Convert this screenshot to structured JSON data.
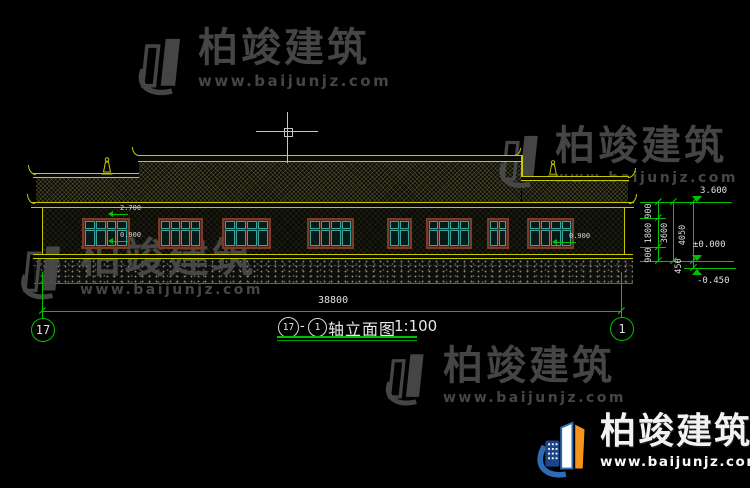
{
  "brand": {
    "name": "柏竣建筑",
    "url": "www.baijunjz.com"
  },
  "title_block": {
    "axis_from": "17",
    "separator": "-",
    "axis_to": "1",
    "title": "轴立面图",
    "scale": "1:100"
  },
  "axis_bubbles": {
    "left": "17",
    "right": "1"
  },
  "dimensions": {
    "overall_width": "38800",
    "right_chain_segments": [
      "900",
      "1800",
      "900"
    ],
    "story_height": "3600",
    "total_height": "4050",
    "plinth_height": "450"
  },
  "levels": {
    "eave": "3.600",
    "ground": "±0.000",
    "base": "-0.450"
  },
  "window_marks": {
    "lintel": "2.700",
    "sill_left": "0.900",
    "sill_right": "0.900"
  },
  "elevation": {
    "windows": [
      {
        "x": 82,
        "w": 48,
        "panes": 4
      },
      {
        "x": 158,
        "w": 45,
        "panes": 4
      },
      {
        "x": 222,
        "w": 49,
        "panes": 4
      },
      {
        "x": 307,
        "w": 47,
        "panes": 4
      },
      {
        "x": 387,
        "w": 25,
        "panes": 2
      },
      {
        "x": 426,
        "w": 46,
        "panes": 4
      },
      {
        "x": 487,
        "w": 22,
        "panes": 2
      },
      {
        "x": 527,
        "w": 47,
        "panes": 4
      }
    ]
  },
  "colors": {
    "line_yellow": "#c8c800",
    "dim_green": "#00c000",
    "text_white": "#e0e0e0",
    "window_teal": "#3aa39a",
    "frame_brown": "#7c3a28",
    "watermark_grey": "#4b4b4b",
    "logo_blue": "#2e6bb5",
    "logo_navy": "#1b4587",
    "logo_orange": "#f7941e"
  }
}
